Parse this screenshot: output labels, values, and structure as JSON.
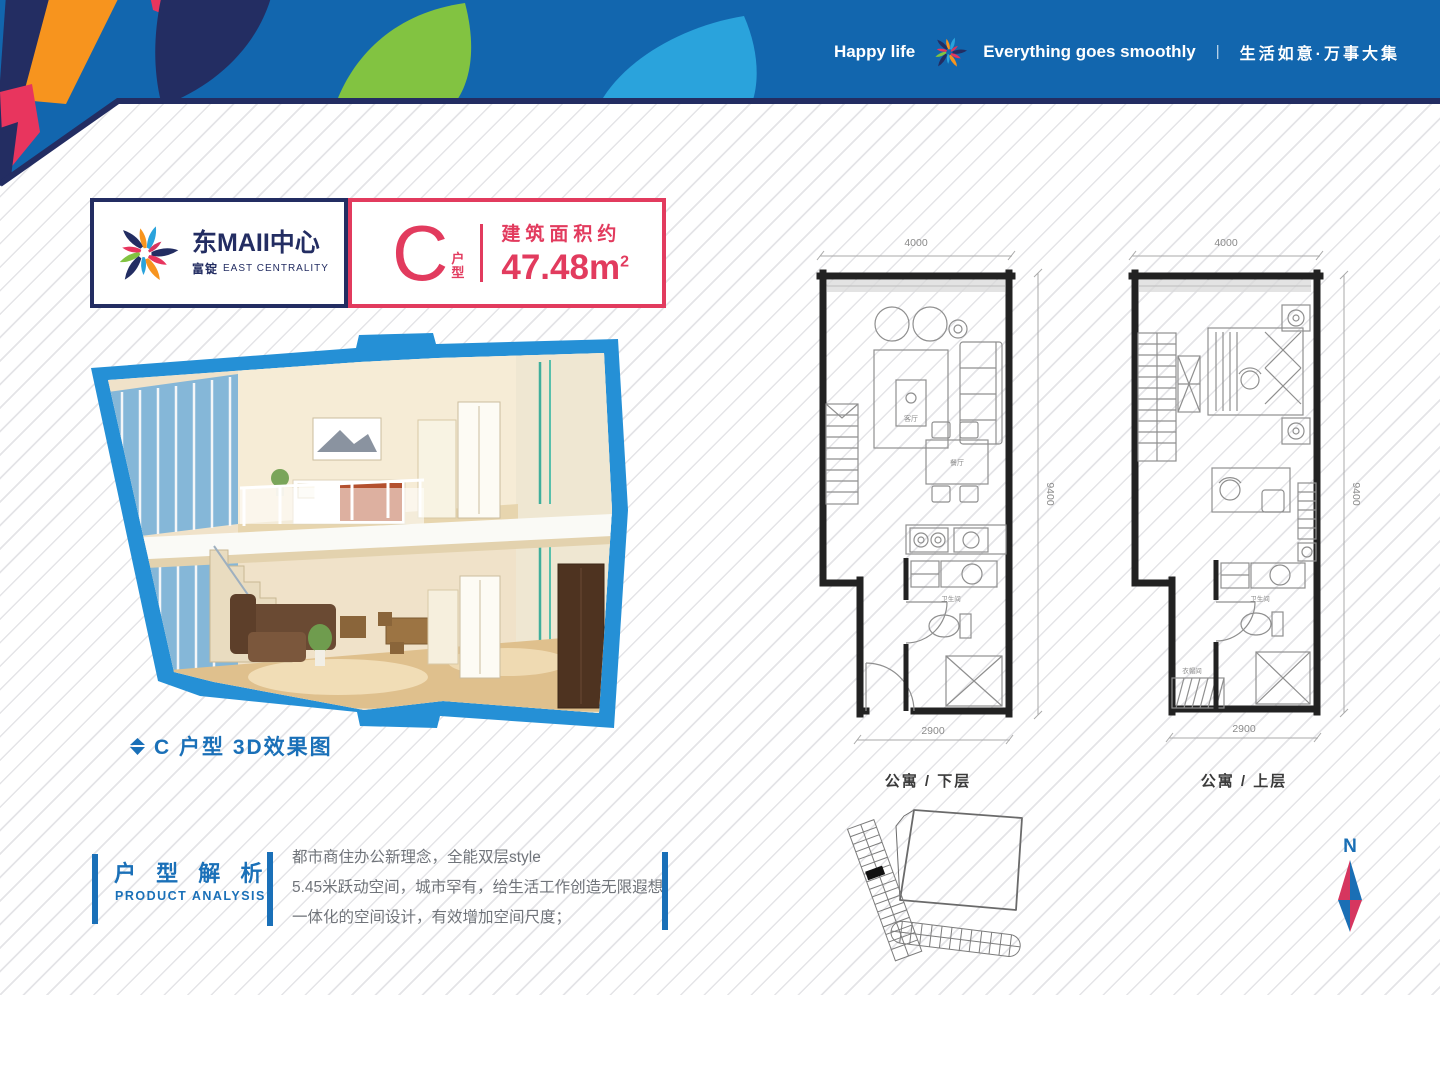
{
  "header": {
    "greeting_en": "Happy life",
    "slogan_en": "Everything goes smoothly",
    "divider": "|",
    "slogan_cn": "生活如意·万事大集"
  },
  "brand": {
    "name": "东MAII中心",
    "sub_cn": "富锭",
    "sub_en": "EAST CENTRALITY"
  },
  "unit": {
    "letter": "C",
    "type_chars": [
      "户",
      "型"
    ],
    "area_label": "建筑面积约",
    "area_value": "47.48m",
    "area_sup": "2"
  },
  "render": {
    "caption": "C 户型 3D效果图"
  },
  "plans": {
    "lower": {
      "dim_top": "4000",
      "dim_right": "9400",
      "dim_bottom": "2900",
      "caption": "公寓 / 下层",
      "labels": {
        "living": "客厅",
        "dining": "餐厅",
        "bath": "卫生间"
      }
    },
    "upper": {
      "dim_top": "4000",
      "dim_right": "9400",
      "dim_bottom": "2900",
      "caption": "公寓 / 上层",
      "labels": {
        "bath": "卫生间",
        "closet": "衣帽间"
      }
    }
  },
  "analysis": {
    "title_cn": "户 型 解 析",
    "title_en": "PRODUCT ANALYSIS",
    "lines": [
      "都市商住办公新理念，全能双层style",
      "5.45米跃动空间，城市罕有，给生活工作创造无限遐想",
      "一体化的空间设计，有效增加空间尺度；"
    ]
  },
  "compass": {
    "north": "N"
  },
  "colors": {
    "band_blue": "#1266ae",
    "navy": "#232d62",
    "orange": "#f7941e",
    "crimson": "#e8355e",
    "green": "#82c341",
    "sky": "#2aa3dc",
    "accent_blue": "#1a70b8",
    "frame_blue": "#2590d6",
    "unit_red": "#e23b5e"
  }
}
